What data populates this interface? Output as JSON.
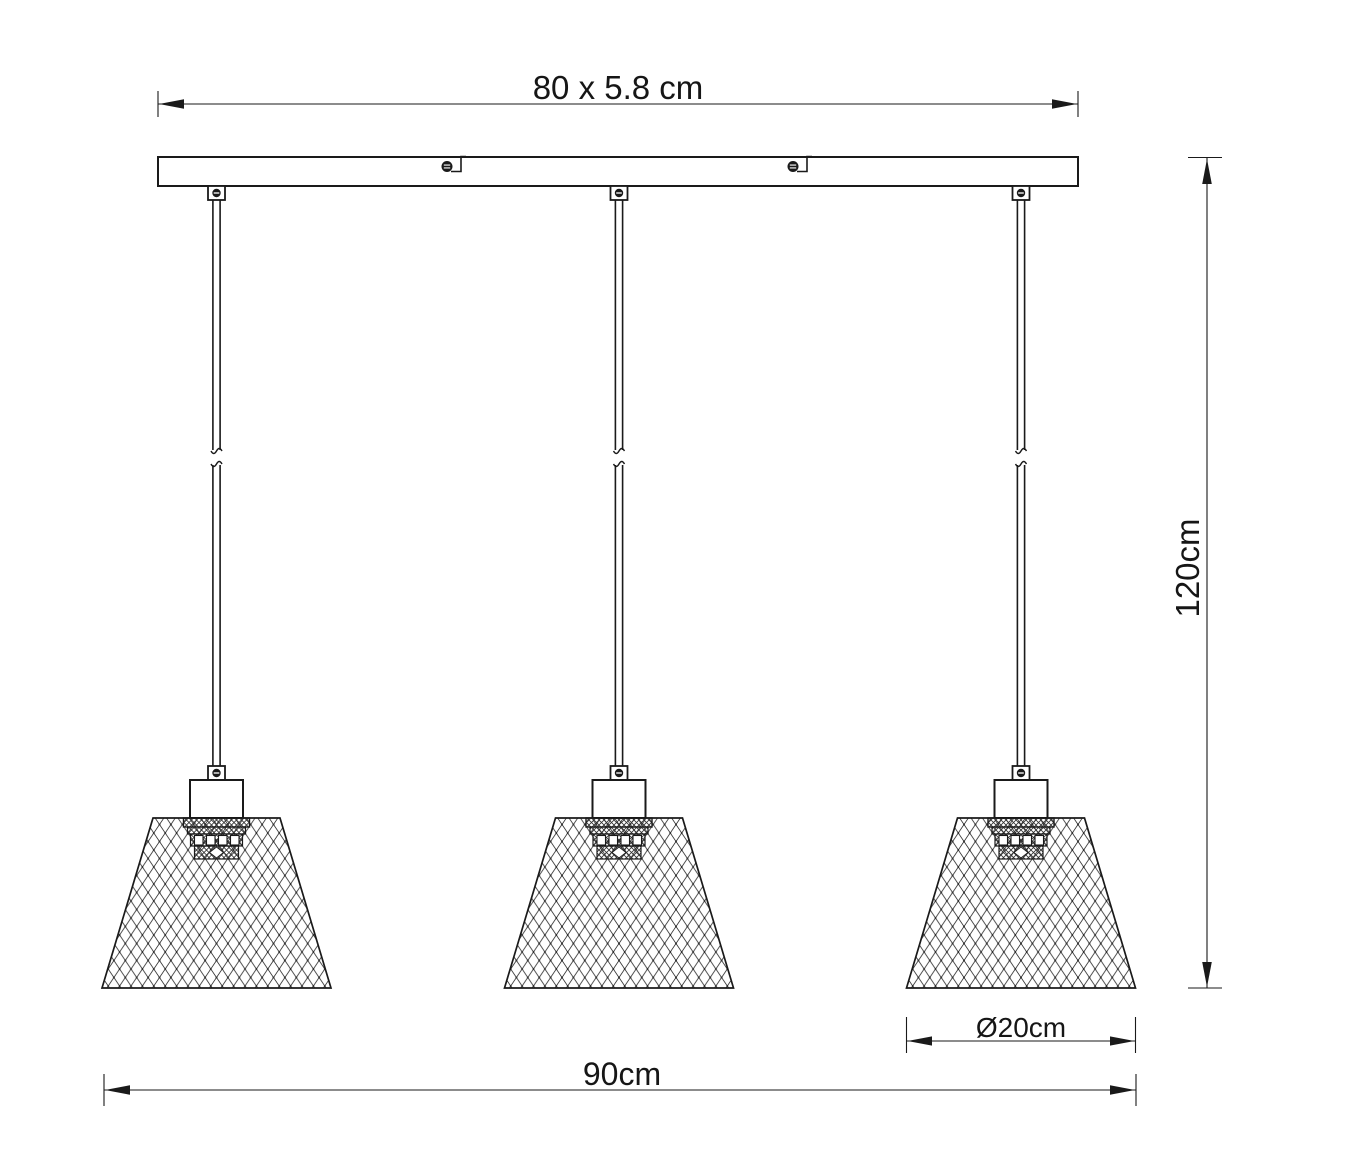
{
  "drawing": {
    "background_color": "#ffffff",
    "line_color": "#1a1a1a",
    "pendant_count": 3,
    "labels": {
      "canopy_size": "80 x 5.8 cm",
      "total_height": "120cm",
      "shade_diameter": "Ø20cm",
      "total_width": "90cm"
    }
  }
}
